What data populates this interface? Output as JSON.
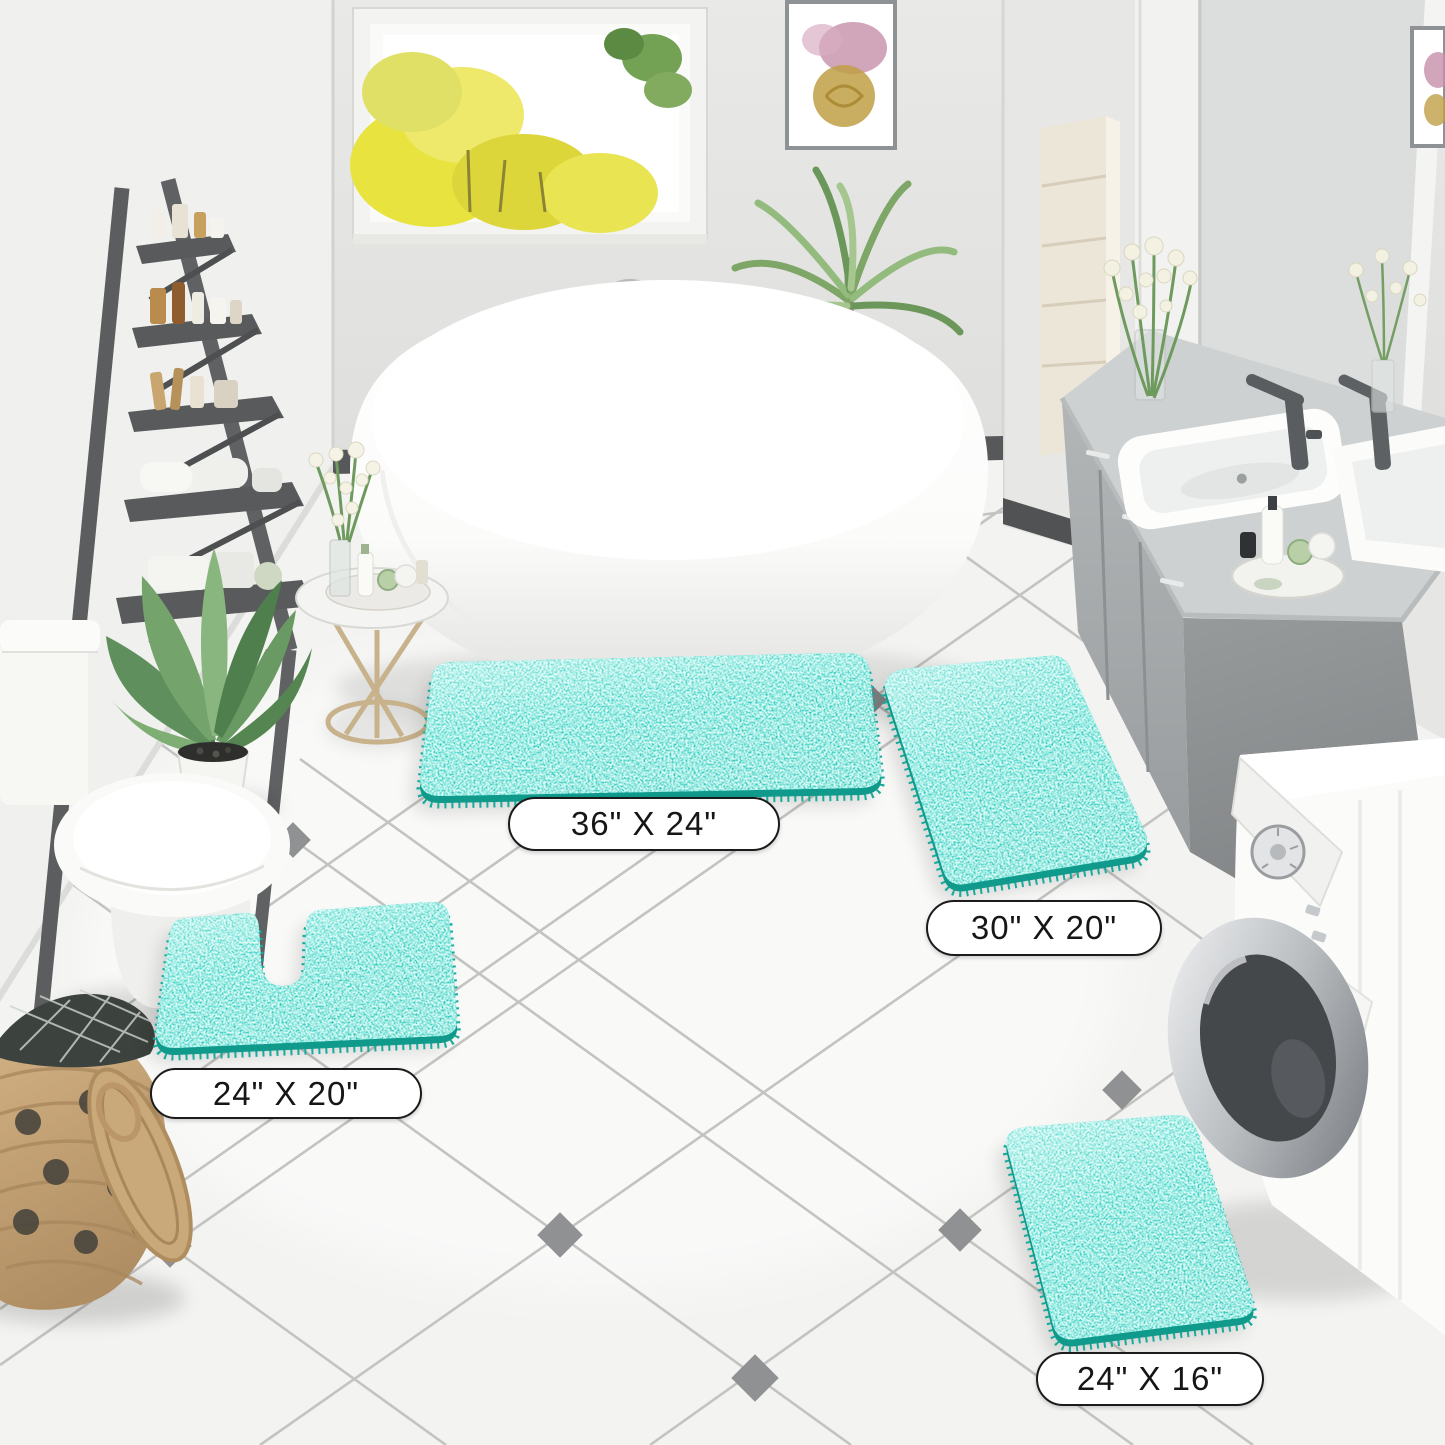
{
  "labels": [
    {
      "text": "36\" X 24\""
    },
    {
      "text": "30\" X 20\""
    },
    {
      "text": "24\" X 20\""
    },
    {
      "text": "24\" X 16\""
    }
  ],
  "colors": {
    "rug_light": "#48ddcb",
    "rug": "#2bd0bf",
    "rug_dark": "#1db4a4",
    "rug_under": "#0f9a8c",
    "rug_fringe": "#16ab9c",
    "label_background": "#ffffff",
    "label_border": "#1b1b1b",
    "label_text": "#161616"
  }
}
